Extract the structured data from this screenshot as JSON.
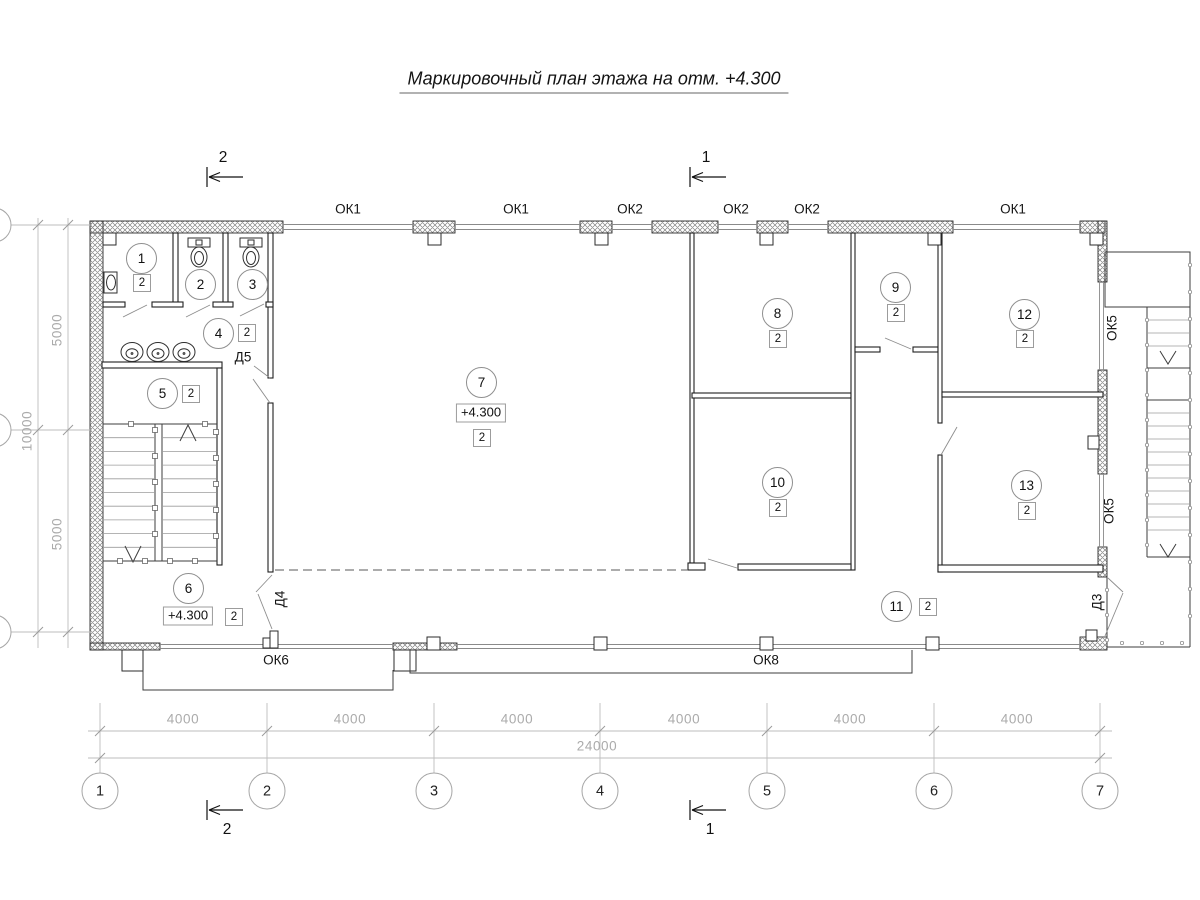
{
  "title": "Маркировочный план этажа на отм. +4.300",
  "elevation_mark": "+4.300",
  "category_label": "2",
  "window_labels": [
    {
      "text": "ОК1",
      "x": 348,
      "y": 209
    },
    {
      "text": "ОК1",
      "x": 516,
      "y": 209
    },
    {
      "text": "ОК2",
      "x": 630,
      "y": 209
    },
    {
      "text": "ОК2",
      "x": 736,
      "y": 209
    },
    {
      "text": "ОК2",
      "x": 807,
      "y": 209
    },
    {
      "text": "ОК1",
      "x": 1013,
      "y": 209
    },
    {
      "text": "ОК6",
      "x": 276,
      "y": 660
    },
    {
      "text": "ОК8",
      "x": 766,
      "y": 660
    },
    {
      "text": "ОК5",
      "x": 1112,
      "y": 328,
      "rot": true
    },
    {
      "text": "ОК5",
      "x": 1109,
      "y": 511,
      "rot": true
    }
  ],
  "door_labels": [
    {
      "text": "Д5",
      "x": 243,
      "y": 357
    },
    {
      "text": "Д4",
      "x": 280,
      "y": 599,
      "rot": true
    },
    {
      "text": "Д3",
      "x": 1097,
      "y": 602,
      "rot": true
    }
  ],
  "rooms": [
    {
      "num": "1",
      "cx": 141,
      "cy": 258,
      "cat": {
        "x": 141,
        "y": 282
      }
    },
    {
      "num": "2",
      "cx": 200,
      "cy": 284
    },
    {
      "num": "3",
      "cx": 252,
      "cy": 284
    },
    {
      "num": "4",
      "cx": 218,
      "cy": 333,
      "cat": {
        "x": 246,
        "y": 332
      }
    },
    {
      "num": "5",
      "cx": 162,
      "cy": 393,
      "cat": {
        "x": 190,
        "y": 393
      }
    },
    {
      "num": "6",
      "cx": 188,
      "cy": 588,
      "elev": {
        "x": 188,
        "y": 616
      },
      "cat": {
        "x": 233,
        "y": 616
      }
    },
    {
      "num": "7",
      "cx": 481,
      "cy": 382,
      "elev": {
        "x": 481,
        "y": 413
      },
      "cat": {
        "x": 481,
        "y": 437
      }
    },
    {
      "num": "8",
      "cx": 777,
      "cy": 313,
      "cat": {
        "x": 777,
        "y": 338
      }
    },
    {
      "num": "9",
      "cx": 895,
      "cy": 287,
      "cat": {
        "x": 895,
        "y": 312
      }
    },
    {
      "num": "10",
      "cx": 777,
      "cy": 482,
      "cat": {
        "x": 777,
        "y": 507
      }
    },
    {
      "num": "11",
      "cx": 896,
      "cy": 606,
      "cat": {
        "x": 927,
        "y": 606
      }
    },
    {
      "num": "12",
      "cx": 1024,
      "cy": 314,
      "cat": {
        "x": 1024,
        "y": 338
      }
    },
    {
      "num": "13",
      "cx": 1026,
      "cy": 485,
      "cat": {
        "x": 1026,
        "y": 510
      }
    }
  ],
  "axis_bubbles": [
    {
      "label": "1",
      "x": 100
    },
    {
      "label": "2",
      "x": 267
    },
    {
      "label": "3",
      "x": 434
    },
    {
      "label": "4",
      "x": 600
    },
    {
      "label": "5",
      "x": 767
    },
    {
      "label": "6",
      "x": 934
    },
    {
      "label": "7",
      "x": 1100
    }
  ],
  "dims_bottom": {
    "segments": [
      {
        "text": "4000",
        "x": 183
      },
      {
        "text": "4000",
        "x": 350
      },
      {
        "text": "4000",
        "x": 517
      },
      {
        "text": "4000",
        "x": 684
      },
      {
        "text": "4000",
        "x": 850
      },
      {
        "text": "4000",
        "x": 1017
      }
    ],
    "total": {
      "text": "24000",
      "x": 597,
      "y": 746
    }
  },
  "dims_left": [
    {
      "text": "5000",
      "x": 57,
      "y": 330
    },
    {
      "text": "5000",
      "x": 57,
      "y": 534
    },
    {
      "text": "10000",
      "x": 27,
      "y": 431
    }
  ],
  "section_marks": [
    {
      "label": "2",
      "x": 207,
      "y": 177,
      "text_pos": "above"
    },
    {
      "label": "1",
      "x": 690,
      "y": 177,
      "text_pos": "above"
    },
    {
      "label": "2",
      "x": 207,
      "y": 810,
      "text_pos": "below"
    },
    {
      "label": "1",
      "x": 690,
      "y": 810,
      "text_pos": "below"
    }
  ]
}
